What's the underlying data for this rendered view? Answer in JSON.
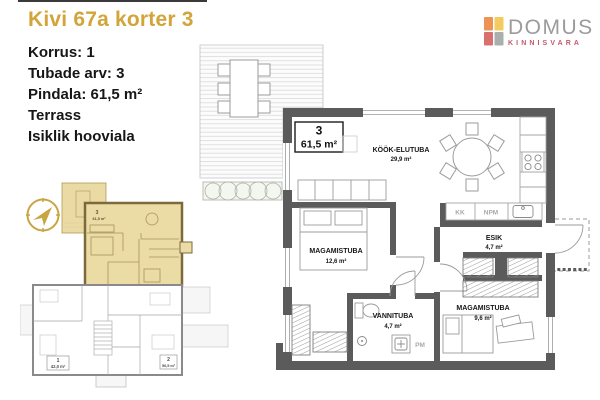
{
  "header": {
    "title": "Kivi 67a korter 3",
    "title_color": "#D2A43A"
  },
  "info": {
    "lines": [
      "Korrus: 1",
      "Tubade arv: 3",
      "Pindala: 61,5 m²",
      "Terrass",
      "Isiklik hooviala"
    ]
  },
  "logo": {
    "name": "DOMUS",
    "subtitle": "KINNISVARA",
    "name_color": "#9B9B9B",
    "subtitle_color": "#C4596B",
    "squares": {
      "tl": "#EC9355",
      "tr": "#F2CC60",
      "bl": "#D97070",
      "br": "#A9AFAC"
    }
  },
  "main_plan": {
    "unit_number": "3",
    "unit_area": "61,5 m²",
    "wall_color": "#5b5b5b",
    "rooms": {
      "kitchen_living": {
        "name": "KÖÖK-ELUTUBA",
        "area": "29,9 m²"
      },
      "bedroom1": {
        "name": "MAGAMISTUBA",
        "area": "12,6 m²"
      },
      "hall": {
        "name": "ESIK",
        "area": "4,7 m²"
      },
      "bathroom": {
        "name": "VANNITUBA",
        "area": "4,7 m²"
      },
      "bedroom2": {
        "name": "MAGAMISTUBA",
        "area": "9,6 m²"
      }
    },
    "appliances": {
      "fridge": "KK",
      "dishwasher": "NPM",
      "washer": "PM"
    }
  },
  "site_plan": {
    "units": [
      {
        "number": "1",
        "area": "42,0 m²"
      },
      {
        "number": "2",
        "area": "56,5 m²"
      },
      {
        "number": "3",
        "area": "61,5 m²"
      }
    ],
    "highlight_color": "#EBDCA6",
    "compass_color": "#C8A544"
  }
}
